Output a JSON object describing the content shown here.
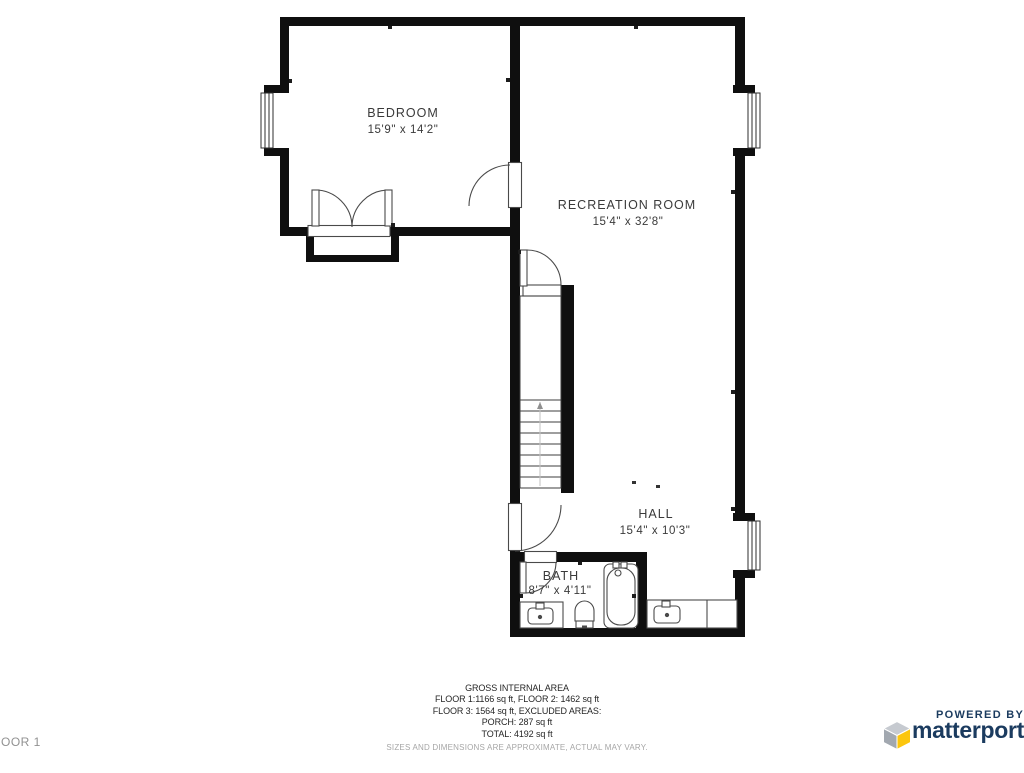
{
  "plan": {
    "rooms": [
      {
        "name": "BEDROOM",
        "dims": "15'9\" x 14'2\""
      },
      {
        "name": "RECREATION ROOM",
        "dims": "15'4\" x 32'8\""
      },
      {
        "name": "HALL",
        "dims": "15'4\" x 10'3\""
      },
      {
        "name": "BATH",
        "dims": "8'7\" x 4'11\""
      }
    ]
  },
  "footer": {
    "title": "GROSS INTERNAL AREA",
    "line1": "FLOOR 1:1166 sq ft, FLOOR 2: 1462 sq ft",
    "line2": "FLOOR 3: 1564 sq ft, EXCLUDED AREAS:",
    "line3": "PORCH: 287 sq ft",
    "line4": "TOTAL: 4192 sq ft",
    "disclaimer": "SIZES AND DIMENSIONS ARE APPROXIMATE, ACTUAL MAY VARY."
  },
  "floor_label": "OOR 1",
  "branding": {
    "powered_by": "POWERED BY",
    "brand_name": "matterport"
  },
  "colors": {
    "wall": "#0f0f0f",
    "line": "#474747",
    "brand_navy": "#1b3b5f",
    "brand_yellow": "#fcc60e"
  }
}
